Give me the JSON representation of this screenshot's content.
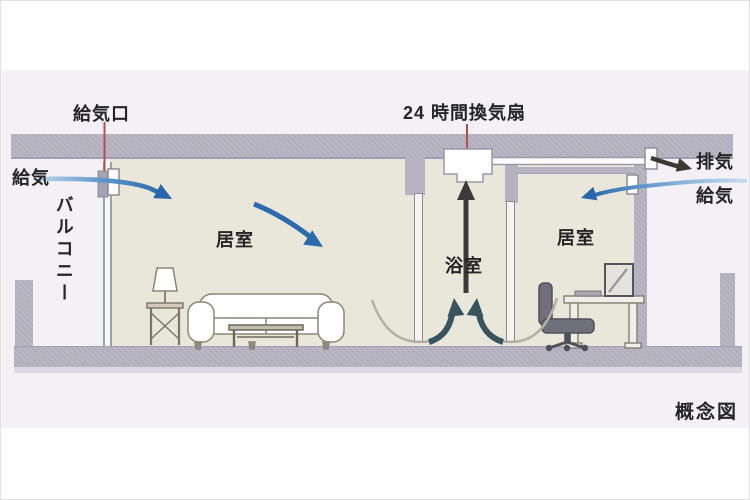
{
  "labels": {
    "supply_port": "給気口",
    "supply_left": "給気",
    "balcony": "バルコニー",
    "living_left": "居室",
    "fan_24h": "24 時間換気扇",
    "bathroom": "浴室",
    "living_right": "居室",
    "exhaust": "排気",
    "supply_right": "給気",
    "caption": "概念図"
  },
  "colors": {
    "structure_gray": "#b5b2c1",
    "room_beige": "#e9e6da",
    "panel_background": "#f3f1f5",
    "supply_arrow_blue": "#2766aa",
    "exhaust_arrow_black": "#3a3a3a",
    "undercut_arrow_teal": "#39545e",
    "leader_line_red": "#b0524a"
  }
}
